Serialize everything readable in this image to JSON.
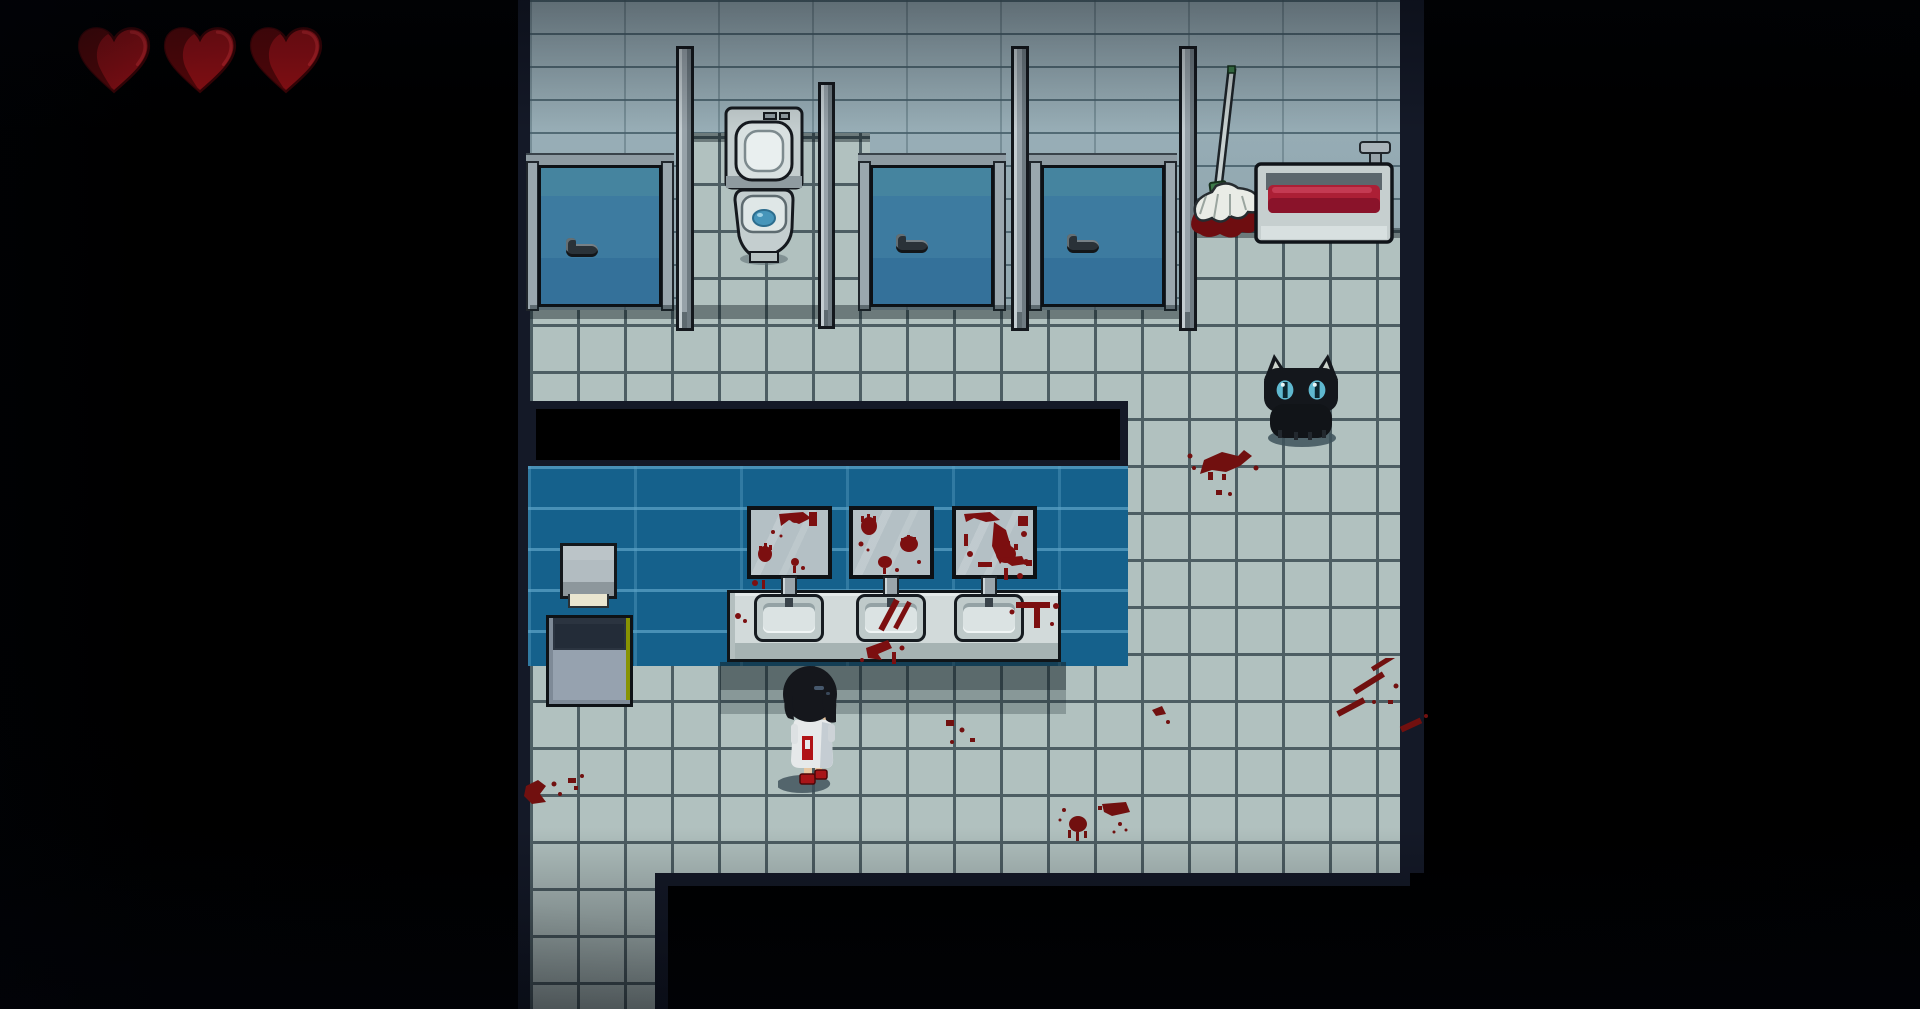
{
  "meta": {
    "app_type": "pixel-art horror adventure game",
    "scene": "blood-stained school restroom, top-down RPG view",
    "letterbox_color": "#000000"
  },
  "hud": {
    "health": {
      "current": 3,
      "max": 3,
      "icon": "heart-icon",
      "color": "#8e0f14",
      "shade": "#560709"
    }
  },
  "palette": {
    "upper_wall": "#97aeb7",
    "floor_tile": "#b1c1bf",
    "floor_grout": "#4d5e63",
    "blue_wall": "#15618c",
    "stall_door": "#3d7ba0",
    "metal_gray": "#97a2a9",
    "blood_dark": "#71100f",
    "blood_bright": "#ac1f35",
    "void_border": "#141927",
    "water_blue": "#4695ba",
    "cat_eye": "#5fb8cf"
  },
  "entities": {
    "player": {
      "label": "player character - girl in white dress with black bob hair and red shoes, facing away"
    },
    "cat": {
      "label": "black cat sitting on tiled floor"
    },
    "toilet": {
      "label": "toilet with open lid in open stall"
    },
    "stall_door_left": {
      "label": "closed stall door (left)"
    },
    "stall_door_middle": {
      "label": "closed stall door (middle)"
    },
    "stall_door_right": {
      "label": "closed stall door (right)"
    },
    "mop": {
      "label": "mop leaning on wall over blood puddle"
    },
    "basin": {
      "label": "utility basin filled with blood, with faucet"
    },
    "mirror_1": {
      "label": "mirror smeared with bloody handprints (left)"
    },
    "mirror_2": {
      "label": "mirror smeared with bloody handprints (middle)"
    },
    "mirror_3": {
      "label": "mirror smeared with bloody handprints (right)"
    },
    "sink_1": {
      "label": "wash basin sink (left)"
    },
    "sink_2": {
      "label": "wash basin sink (middle, blood streaked)"
    },
    "sink_3": {
      "label": "wash basin sink (right)"
    },
    "dispenser": {
      "label": "paper towel dispenser"
    },
    "trash": {
      "label": "trash can"
    },
    "doorway": {
      "label": "dark opening above sink wall"
    },
    "exit": {
      "label": "corridor exit at bottom left"
    }
  },
  "decals": {
    "blood_floor_count": 7,
    "items": [
      "splat near cat",
      "handprint bottom center",
      "diagonal streaks bottom right",
      "splat bottom left",
      "specks right of player",
      "drips under middle sink",
      "streaks on counter right"
    ]
  }
}
